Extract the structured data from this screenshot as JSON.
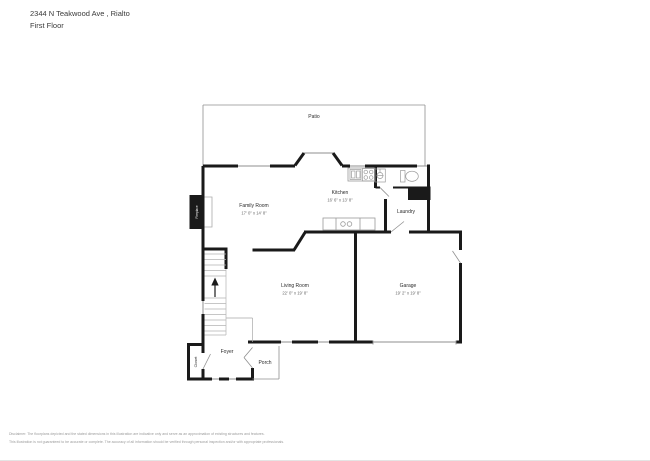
{
  "header": {
    "address": "2344 N Teakwood Ave , Rialto",
    "floor": "First Floor"
  },
  "rooms": {
    "patio": {
      "name": "Patio"
    },
    "family_room": {
      "name": "Family Room",
      "dims": "17' 0\" x 14' 8\""
    },
    "kitchen": {
      "name": "Kitchen",
      "dims": "16' 6\" x 13' 8\""
    },
    "living_room": {
      "name": "Living Room",
      "dims": "22' 0\" x 19' 8\""
    },
    "garage": {
      "name": "Garage",
      "dims": "19' 2\" x 19' 8\""
    },
    "laundry": {
      "name": "Laundry"
    },
    "foyer": {
      "name": "Foyer"
    },
    "porch": {
      "name": "Porch"
    },
    "closet": {
      "name": "Closet"
    },
    "fireplace": {
      "name": "Fireplace"
    }
  },
  "icons": {
    "stairs": "stairs-with-up-arrow",
    "toilet": "toilet-icon",
    "bath_sink": "pedestal-sink-icon",
    "kitchen_sink": "double-bowl-sink-icon",
    "stove": "four-burner-stove-icon",
    "fireplace": "fireplace-block-icon"
  },
  "colors": {
    "wall": "#1a1a1a",
    "thin_line": "#8f8f8f",
    "fixture_line": "#9a9a9a",
    "label_text": "#2b2b2b",
    "dims_text": "#6a6a6a",
    "disclaimer_text": "#9b9b9b"
  },
  "disclaimer": {
    "line1": "Disclaimer: The floorplans depicted and the stated dimensions in this illustration are indicative only and serve as an approximation of existing structures and features.",
    "line2": "This illustration is not guaranteed to be accurate or complete. The accuracy of all information should be verified through personal inspection and/or with appropriate professionals."
  }
}
